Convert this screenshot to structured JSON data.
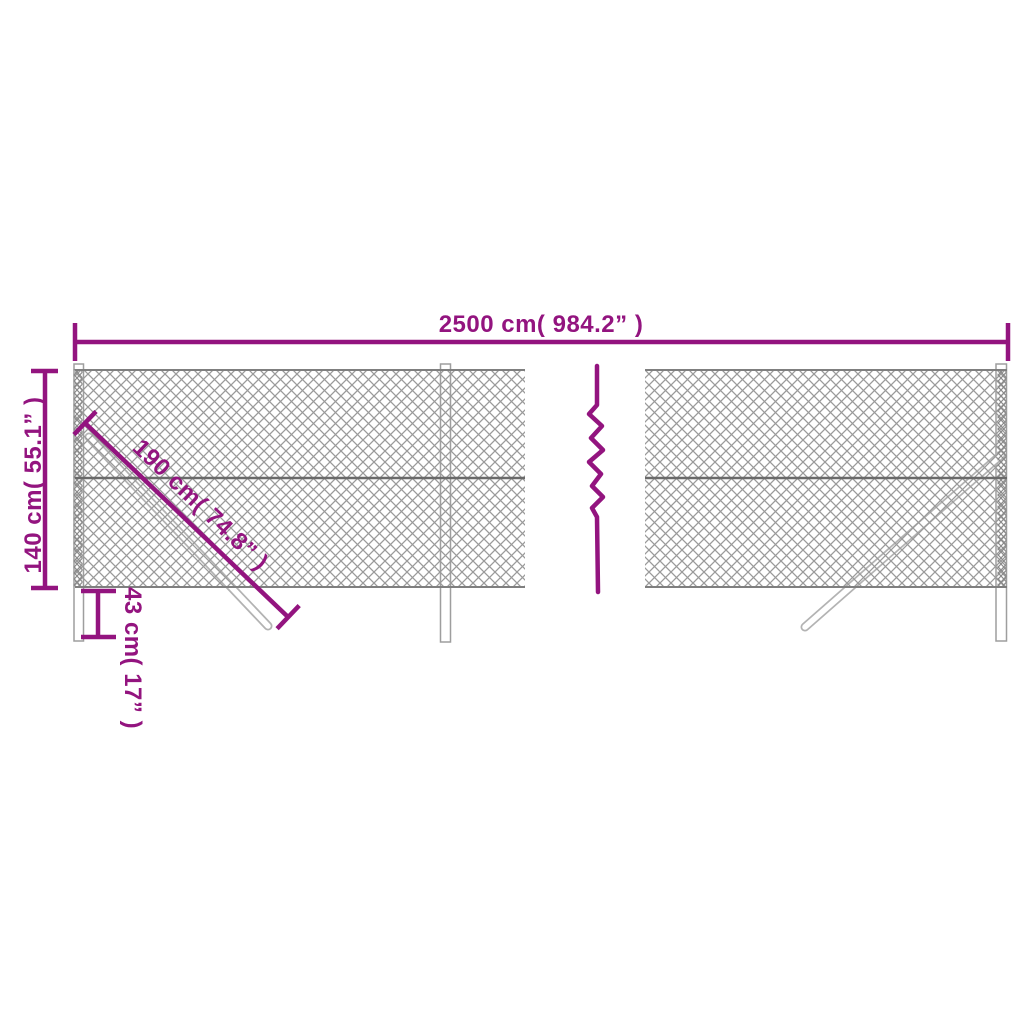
{
  "page": {
    "type": "product-dimension-diagram",
    "subject": "chain-link fence with posts and braces"
  },
  "colors": {
    "background": "#ffffff",
    "accent_purple": "#93147f",
    "mesh_gray": "#9a9a9a",
    "mesh_edge_gray": "#8a8a8a",
    "wire_gray": "#6a6a6a",
    "post_outline_gray": "#9e9e9e"
  },
  "dimensions": {
    "total_width": {
      "label": "2500 cm( 984.2” )",
      "metric": "2500 cm",
      "imperial": "984.2”"
    },
    "fence_height": {
      "label": "140 cm( 55.1” )",
      "metric": "140 cm",
      "imperial": "55.1”"
    },
    "brace_length": {
      "label": "190 cm( 74.8” )",
      "metric": "190 cm",
      "imperial": "74.8”"
    },
    "post_depth": {
      "label": "43 cm( 17” )",
      "metric": "43 cm",
      "imperial": "17”"
    }
  }
}
